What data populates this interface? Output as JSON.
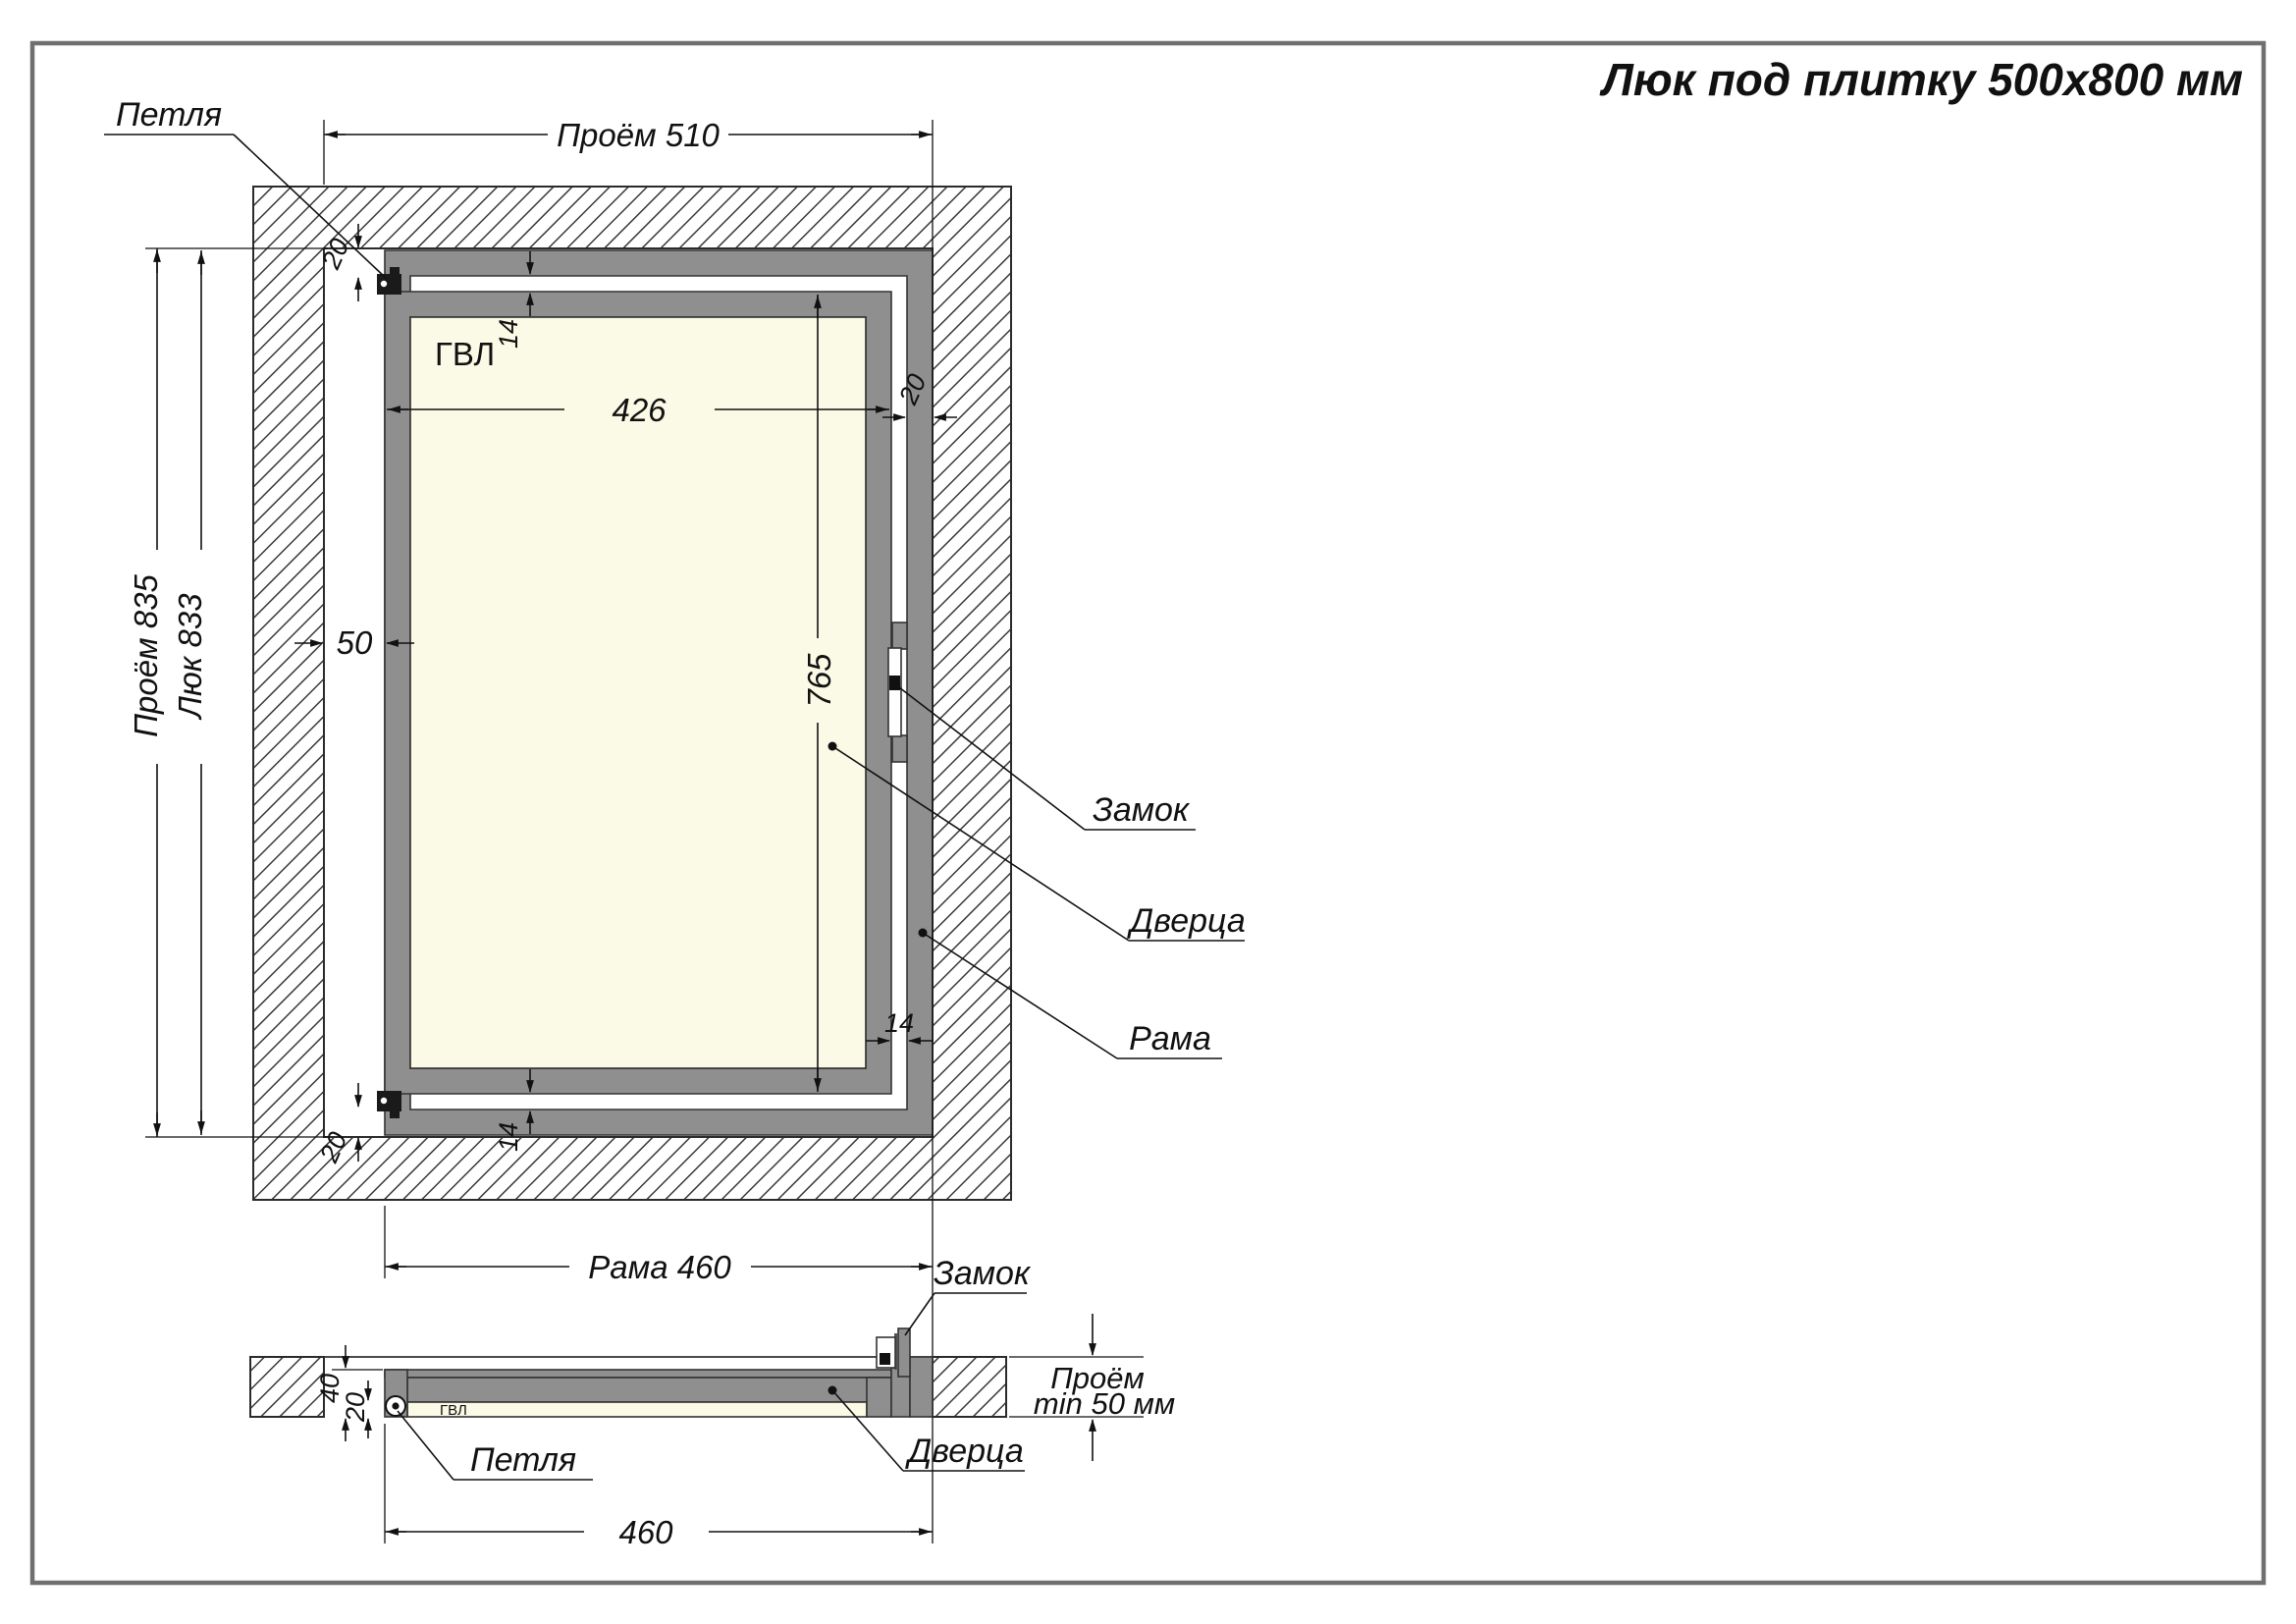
{
  "title": "Люк под плитку 500х800 мм",
  "front": {
    "material": "ГВЛ",
    "dims": {
      "opening_w": "Проём 510",
      "opening_h": "Проём 835",
      "hatch_h": "Люк 833",
      "frame_w": "Рама 460",
      "panel_w": "426",
      "panel_h": "765",
      "left_gap": "50",
      "profile": "20",
      "slot": "14"
    },
    "callouts": {
      "hinge": "Петля",
      "lock": "Замок",
      "door": "Дверца",
      "frame": "Рама"
    }
  },
  "section": {
    "material": "ГВЛ",
    "dims": {
      "frame_w": "460",
      "depth": "40",
      "panel_t": "20",
      "opening_line1": "Проём",
      "opening_line2": "min 50 мм"
    },
    "callouts": {
      "hinge": "Петля",
      "lock": "Замок",
      "door": "Дверца"
    }
  },
  "colors": {
    "metal": "#8f8f8f",
    "panel": "#fbfae6",
    "line": "#1a1a1a"
  }
}
